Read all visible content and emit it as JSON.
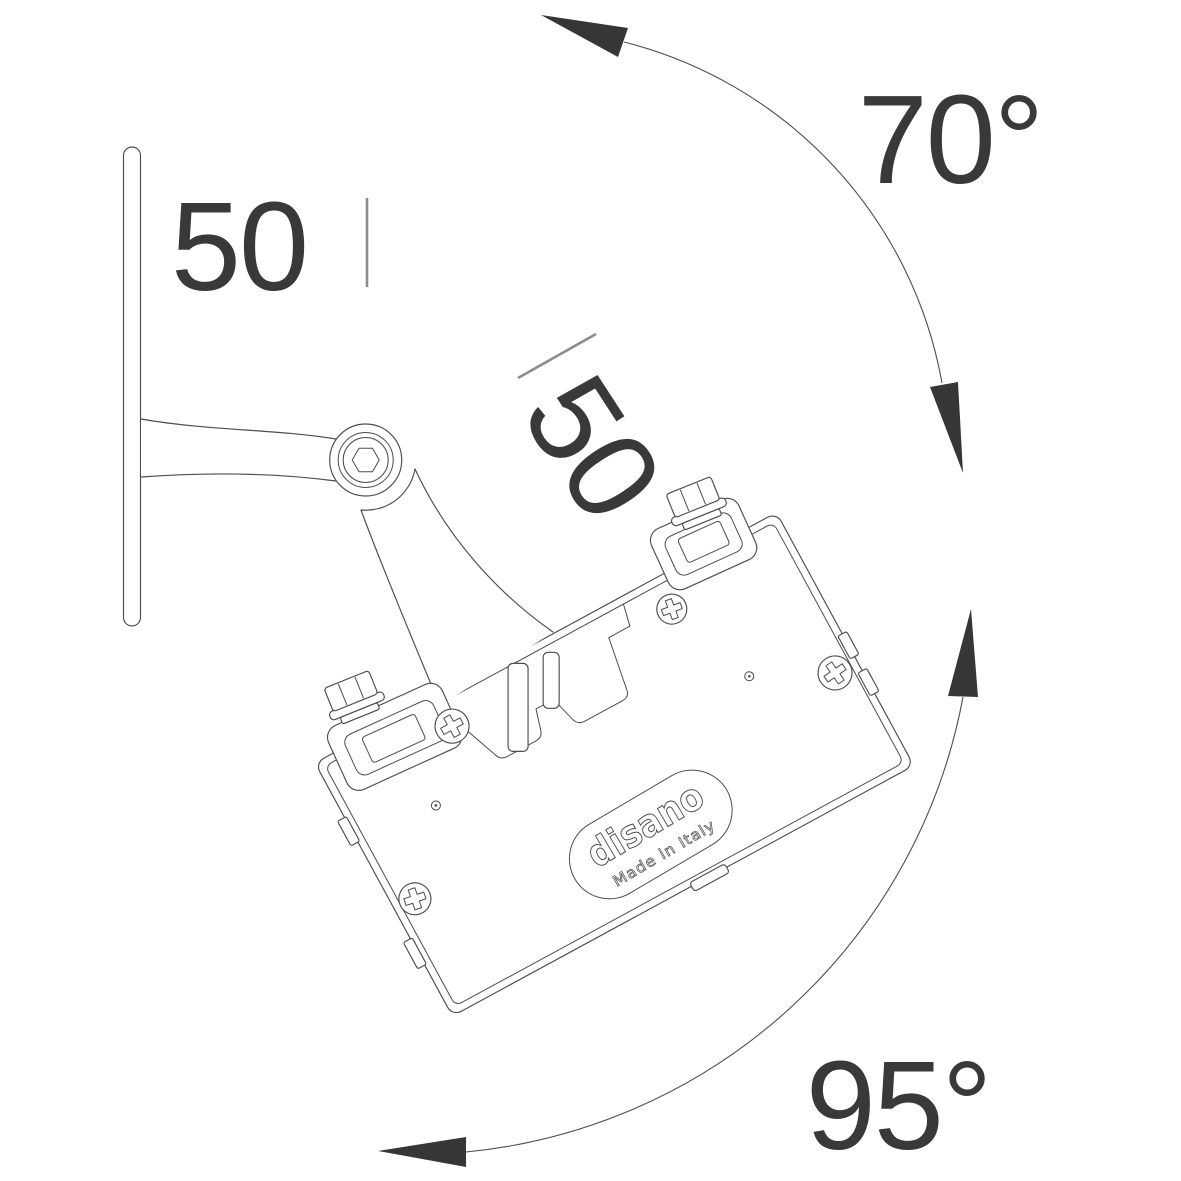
{
  "drawing": {
    "title": "floodlight-mounting-rotation-diagram",
    "dimensions": {
      "wall_offset": "50",
      "arm_length": "50"
    },
    "angles": {
      "tilt_up": "70°",
      "tilt_down": "95°"
    },
    "logo": {
      "brand": "disano",
      "origin": "Made in Italy"
    }
  },
  "colors": {
    "background": "#ffffff",
    "line": "#4d4d4d",
    "text": "#39393b",
    "arrow": "#363639",
    "tick": "#8c8c8c"
  }
}
